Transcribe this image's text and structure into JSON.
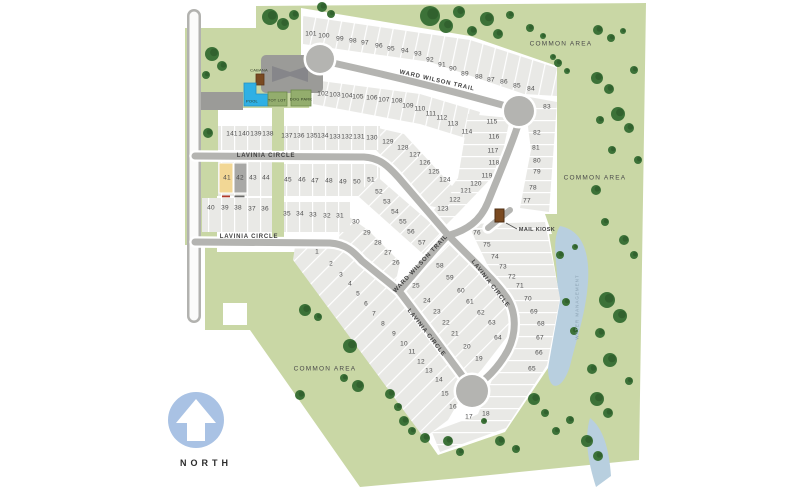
{
  "map": {
    "north": {
      "label": "NORTH",
      "x": 206,
      "y": 463
    },
    "streets": [
      {
        "label": "WARD WILSON TRAIL",
        "x": 437,
        "y": 81,
        "rotate": 13
      },
      {
        "label": "WARD WILSON TRAIL",
        "x": 421,
        "y": 264,
        "rotate": -47
      },
      {
        "label": "LAVINIA CIRCLE",
        "x": 266,
        "y": 156,
        "rotate": 0
      },
      {
        "label": "LAVINIA CIRCLE",
        "x": 249,
        "y": 237,
        "rotate": 0
      },
      {
        "label": "LAVINIA CIRCLE",
        "x": 490,
        "y": 284,
        "rotate": 52
      },
      {
        "label": "LAVINIA CIRCLE",
        "x": 426,
        "y": 333,
        "rotate": 52
      }
    ],
    "areas": [
      {
        "label": "COMMON AREA",
        "x": 561,
        "y": 44,
        "rotate": 0,
        "cls": "area-label"
      },
      {
        "label": "COMMON AREA",
        "x": 595,
        "y": 178,
        "rotate": 0,
        "cls": "area-label"
      },
      {
        "label": "COMMON AREA",
        "x": 325,
        "y": 369,
        "rotate": 0,
        "cls": "area-label"
      },
      {
        "label": "WATER MANAGEMENT",
        "x": 577,
        "y": 307,
        "rotate": -90,
        "cls": "water-label"
      }
    ],
    "amenities": [
      {
        "id": "cabana",
        "label": "CABANA",
        "x": 259,
        "y": 70,
        "cls": "amenity-label"
      },
      {
        "id": "pool",
        "label": "POOL",
        "x": 252,
        "y": 101,
        "cls": "amenity-label"
      },
      {
        "id": "tot-lot",
        "label": "TOT LOT",
        "x": 277,
        "y": 100,
        "cls": "amenity-label"
      },
      {
        "id": "dog-park",
        "label": "DOG PARK",
        "x": 301,
        "y": 99,
        "cls": "amenity-label"
      },
      {
        "id": "mail-kiosk",
        "label": "MAIL KIOSK",
        "x": 537,
        "y": 230,
        "cls": "kiosk-label"
      }
    ],
    "colors": {
      "site_green": "#c9d7a5",
      "lot_gray": "#e9e9e6",
      "road_gray": "#b4b4b1",
      "pond_blue": "#b8cfdf",
      "pool_blue": "#2fb0e4",
      "north_blue": "#a9c2e4",
      "tree_green": "#3c7238",
      "kiosk_brown": "#7a4a21",
      "lot41_highlight": "#f2d795",
      "lot42_highlight": "#a8a8a6"
    },
    "lots": [
      {
        "n": 1,
        "x": 317,
        "y": 252
      },
      {
        "n": 2,
        "x": 331,
        "y": 264
      },
      {
        "n": 3,
        "x": 341,
        "y": 275
      },
      {
        "n": 4,
        "x": 350,
        "y": 284
      },
      {
        "n": 5,
        "x": 358,
        "y": 294
      },
      {
        "n": 6,
        "x": 366,
        "y": 304
      },
      {
        "n": 7,
        "x": 374,
        "y": 314
      },
      {
        "n": 8,
        "x": 383,
        "y": 324
      },
      {
        "n": 9,
        "x": 394,
        "y": 334
      },
      {
        "n": 10,
        "x": 404,
        "y": 344
      },
      {
        "n": 11,
        "x": 412,
        "y": 352
      },
      {
        "n": 12,
        "x": 421,
        "y": 362
      },
      {
        "n": 13,
        "x": 429,
        "y": 371
      },
      {
        "n": 14,
        "x": 439,
        "y": 380
      },
      {
        "n": 15,
        "x": 445,
        "y": 394
      },
      {
        "n": 16,
        "x": 453,
        "y": 407
      },
      {
        "n": 17,
        "x": 469,
        "y": 417
      },
      {
        "n": 18,
        "x": 486,
        "y": 414
      },
      {
        "n": 19,
        "x": 479,
        "y": 359
      },
      {
        "n": 20,
        "x": 467,
        "y": 347
      },
      {
        "n": 21,
        "x": 455,
        "y": 334
      },
      {
        "n": 22,
        "x": 446,
        "y": 323
      },
      {
        "n": 23,
        "x": 437,
        "y": 312
      },
      {
        "n": 24,
        "x": 427,
        "y": 301
      },
      {
        "n": 25,
        "x": 416,
        "y": 286
      },
      {
        "n": 26,
        "x": 396,
        "y": 263
      },
      {
        "n": 27,
        "x": 388,
        "y": 253
      },
      {
        "n": 28,
        "x": 378,
        "y": 243
      },
      {
        "n": 29,
        "x": 367,
        "y": 233
      },
      {
        "n": 30,
        "x": 356,
        "y": 222
      },
      {
        "n": 31,
        "x": 340,
        "y": 216
      },
      {
        "n": 32,
        "x": 327,
        "y": 216
      },
      {
        "n": 33,
        "x": 313,
        "y": 215
      },
      {
        "n": 34,
        "x": 300,
        "y": 214
      },
      {
        "n": 35,
        "x": 287,
        "y": 214
      },
      {
        "n": 36,
        "x": 265,
        "y": 209
      },
      {
        "n": 37,
        "x": 252,
        "y": 209
      },
      {
        "n": 38,
        "x": 238,
        "y": 208
      },
      {
        "n": 39,
        "x": 225,
        "y": 208
      },
      {
        "n": 40,
        "x": 211,
        "y": 208
      },
      {
        "n": 41,
        "x": 227,
        "y": 178
      },
      {
        "n": 42,
        "x": 240,
        "y": 178
      },
      {
        "n": 43,
        "x": 253,
        "y": 178
      },
      {
        "n": 44,
        "x": 266,
        "y": 178
      },
      {
        "n": 45,
        "x": 288,
        "y": 180
      },
      {
        "n": 46,
        "x": 302,
        "y": 180
      },
      {
        "n": 47,
        "x": 315,
        "y": 181
      },
      {
        "n": 48,
        "x": 329,
        "y": 181
      },
      {
        "n": 49,
        "x": 343,
        "y": 182
      },
      {
        "n": 50,
        "x": 357,
        "y": 182
      },
      {
        "n": 51,
        "x": 371,
        "y": 180
      },
      {
        "n": 52,
        "x": 379,
        "y": 192
      },
      {
        "n": 53,
        "x": 387,
        "y": 202
      },
      {
        "n": 54,
        "x": 395,
        "y": 212
      },
      {
        "n": 55,
        "x": 403,
        "y": 222
      },
      {
        "n": 56,
        "x": 411,
        "y": 232
      },
      {
        "n": 57,
        "x": 422,
        "y": 243
      },
      {
        "n": 58,
        "x": 440,
        "y": 266
      },
      {
        "n": 59,
        "x": 450,
        "y": 278
      },
      {
        "n": 60,
        "x": 461,
        "y": 291
      },
      {
        "n": 61,
        "x": 470,
        "y": 302
      },
      {
        "n": 62,
        "x": 481,
        "y": 313
      },
      {
        "n": 63,
        "x": 492,
        "y": 323
      },
      {
        "n": 64,
        "x": 498,
        "y": 338
      },
      {
        "n": 65,
        "x": 532,
        "y": 369
      },
      {
        "n": 66,
        "x": 539,
        "y": 353
      },
      {
        "n": 67,
        "x": 540,
        "y": 338
      },
      {
        "n": 68,
        "x": 541,
        "y": 324
      },
      {
        "n": 69,
        "x": 534,
        "y": 312
      },
      {
        "n": 70,
        "x": 528,
        "y": 299
      },
      {
        "n": 71,
        "x": 520,
        "y": 286
      },
      {
        "n": 72,
        "x": 512,
        "y": 277
      },
      {
        "n": 73,
        "x": 503,
        "y": 267
      },
      {
        "n": 74,
        "x": 495,
        "y": 257
      },
      {
        "n": 75,
        "x": 487,
        "y": 245
      },
      {
        "n": 76,
        "x": 477,
        "y": 233
      },
      {
        "n": 77,
        "x": 527,
        "y": 201
      },
      {
        "n": 78,
        "x": 533,
        "y": 188
      },
      {
        "n": 79,
        "x": 537,
        "y": 172
      },
      {
        "n": 80,
        "x": 537,
        "y": 161
      },
      {
        "n": 81,
        "x": 536,
        "y": 148
      },
      {
        "n": 82,
        "x": 537,
        "y": 133
      },
      {
        "n": 83,
        "x": 547,
        "y": 107
      },
      {
        "n": 84,
        "x": 531,
        "y": 89
      },
      {
        "n": 85,
        "x": 517,
        "y": 86
      },
      {
        "n": 86,
        "x": 504,
        "y": 82
      },
      {
        "n": 87,
        "x": 491,
        "y": 80
      },
      {
        "n": 88,
        "x": 479,
        "y": 77
      },
      {
        "n": 89,
        "x": 465,
        "y": 74
      },
      {
        "n": 90,
        "x": 453,
        "y": 69
      },
      {
        "n": 91,
        "x": 442,
        "y": 65
      },
      {
        "n": 92,
        "x": 430,
        "y": 60
      },
      {
        "n": 93,
        "x": 418,
        "y": 54
      },
      {
        "n": 94,
        "x": 405,
        "y": 51
      },
      {
        "n": 95,
        "x": 391,
        "y": 49
      },
      {
        "n": 96,
        "x": 379,
        "y": 46
      },
      {
        "n": 97,
        "x": 365,
        "y": 43
      },
      {
        "n": 98,
        "x": 353,
        "y": 41
      },
      {
        "n": 99,
        "x": 340,
        "y": 39
      },
      {
        "n": 100,
        "x": 324,
        "y": 36
      },
      {
        "n": 101,
        "x": 311,
        "y": 34
      },
      {
        "n": 102,
        "x": 323,
        "y": 94
      },
      {
        "n": 103,
        "x": 335,
        "y": 95
      },
      {
        "n": 104,
        "x": 347,
        "y": 96
      },
      {
        "n": 105,
        "x": 358,
        "y": 97
      },
      {
        "n": 106,
        "x": 372,
        "y": 98
      },
      {
        "n": 107,
        "x": 384,
        "y": 100
      },
      {
        "n": 108,
        "x": 397,
        "y": 101
      },
      {
        "n": 109,
        "x": 408,
        "y": 106
      },
      {
        "n": 110,
        "x": 420,
        "y": 109
      },
      {
        "n": 111,
        "x": 431,
        "y": 114
      },
      {
        "n": 112,
        "x": 442,
        "y": 118
      },
      {
        "n": 113,
        "x": 453,
        "y": 124
      },
      {
        "n": 114,
        "x": 467,
        "y": 132
      },
      {
        "n": 115,
        "x": 492,
        "y": 122
      },
      {
        "n": 116,
        "x": 494,
        "y": 137
      },
      {
        "n": 117,
        "x": 493,
        "y": 151
      },
      {
        "n": 118,
        "x": 494,
        "y": 163
      },
      {
        "n": 119,
        "x": 487,
        "y": 176
      },
      {
        "n": 120,
        "x": 476,
        "y": 184
      },
      {
        "n": 121,
        "x": 466,
        "y": 191
      },
      {
        "n": 122,
        "x": 455,
        "y": 200
      },
      {
        "n": 123,
        "x": 443,
        "y": 209
      },
      {
        "n": 124,
        "x": 445,
        "y": 180
      },
      {
        "n": 125,
        "x": 434,
        "y": 172
      },
      {
        "n": 126,
        "x": 425,
        "y": 163
      },
      {
        "n": 127,
        "x": 415,
        "y": 155
      },
      {
        "n": 128,
        "x": 403,
        "y": 148
      },
      {
        "n": 129,
        "x": 388,
        "y": 142
      },
      {
        "n": 130,
        "x": 372,
        "y": 138
      },
      {
        "n": 131,
        "x": 359,
        "y": 137
      },
      {
        "n": 132,
        "x": 347,
        "y": 137
      },
      {
        "n": 133,
        "x": 335,
        "y": 137
      },
      {
        "n": 134,
        "x": 323,
        "y": 136
      },
      {
        "n": 135,
        "x": 312,
        "y": 136
      },
      {
        "n": 136,
        "x": 299,
        "y": 136
      },
      {
        "n": 137,
        "x": 287,
        "y": 136
      },
      {
        "n": 138,
        "x": 268,
        "y": 134
      },
      {
        "n": 139,
        "x": 256,
        "y": 134
      },
      {
        "n": 140,
        "x": 244,
        "y": 134
      },
      {
        "n": 141,
        "x": 232,
        "y": 134
      }
    ],
    "trees": [
      [
        212,
        54,
        7
      ],
      [
        222,
        66,
        5
      ],
      [
        206,
        75,
        4
      ],
      [
        208,
        133,
        5
      ],
      [
        270,
        17,
        8
      ],
      [
        283,
        24,
        6
      ],
      [
        294,
        15,
        5
      ],
      [
        322,
        7,
        5
      ],
      [
        331,
        14,
        4
      ],
      [
        430,
        16,
        10
      ],
      [
        446,
        26,
        7
      ],
      [
        459,
        12,
        6
      ],
      [
        472,
        31,
        5
      ],
      [
        487,
        19,
        7
      ],
      [
        498,
        34,
        5
      ],
      [
        510,
        15,
        4
      ],
      [
        530,
        28,
        4
      ],
      [
        543,
        36,
        3
      ],
      [
        553,
        57,
        3
      ],
      [
        558,
        63,
        4
      ],
      [
        567,
        71,
        3
      ],
      [
        598,
        30,
        5
      ],
      [
        611,
        38,
        4
      ],
      [
        623,
        31,
        3
      ],
      [
        597,
        78,
        6
      ],
      [
        609,
        89,
        5
      ],
      [
        634,
        70,
        4
      ],
      [
        600,
        120,
        4
      ],
      [
        618,
        114,
        7
      ],
      [
        629,
        128,
        5
      ],
      [
        612,
        150,
        4
      ],
      [
        638,
        160,
        4
      ],
      [
        596,
        190,
        5
      ],
      [
        605,
        222,
        4
      ],
      [
        624,
        240,
        5
      ],
      [
        634,
        255,
        4
      ],
      [
        560,
        255,
        4
      ],
      [
        575,
        247,
        3
      ],
      [
        607,
        300,
        8
      ],
      [
        620,
        316,
        7
      ],
      [
        600,
        333,
        5
      ],
      [
        566,
        302,
        4
      ],
      [
        610,
        360,
        7
      ],
      [
        592,
        369,
        5
      ],
      [
        574,
        331,
        4
      ],
      [
        629,
        381,
        4
      ],
      [
        597,
        399,
        7
      ],
      [
        608,
        413,
        5
      ],
      [
        570,
        420,
        4
      ],
      [
        587,
        441,
        6
      ],
      [
        598,
        456,
        5
      ],
      [
        556,
        431,
        4
      ],
      [
        534,
        399,
        6
      ],
      [
        545,
        413,
        4
      ],
      [
        500,
        441,
        5
      ],
      [
        516,
        449,
        4
      ],
      [
        484,
        421,
        3
      ],
      [
        448,
        441,
        5
      ],
      [
        460,
        452,
        4
      ],
      [
        425,
        438,
        5
      ],
      [
        404,
        421,
        5
      ],
      [
        390,
        394,
        5
      ],
      [
        398,
        407,
        4
      ],
      [
        412,
        431,
        4
      ],
      [
        305,
        310,
        6
      ],
      [
        318,
        317,
        4
      ],
      [
        350,
        346,
        7
      ],
      [
        358,
        386,
        6
      ],
      [
        344,
        378,
        4
      ],
      [
        300,
        395,
        5
      ]
    ]
  }
}
